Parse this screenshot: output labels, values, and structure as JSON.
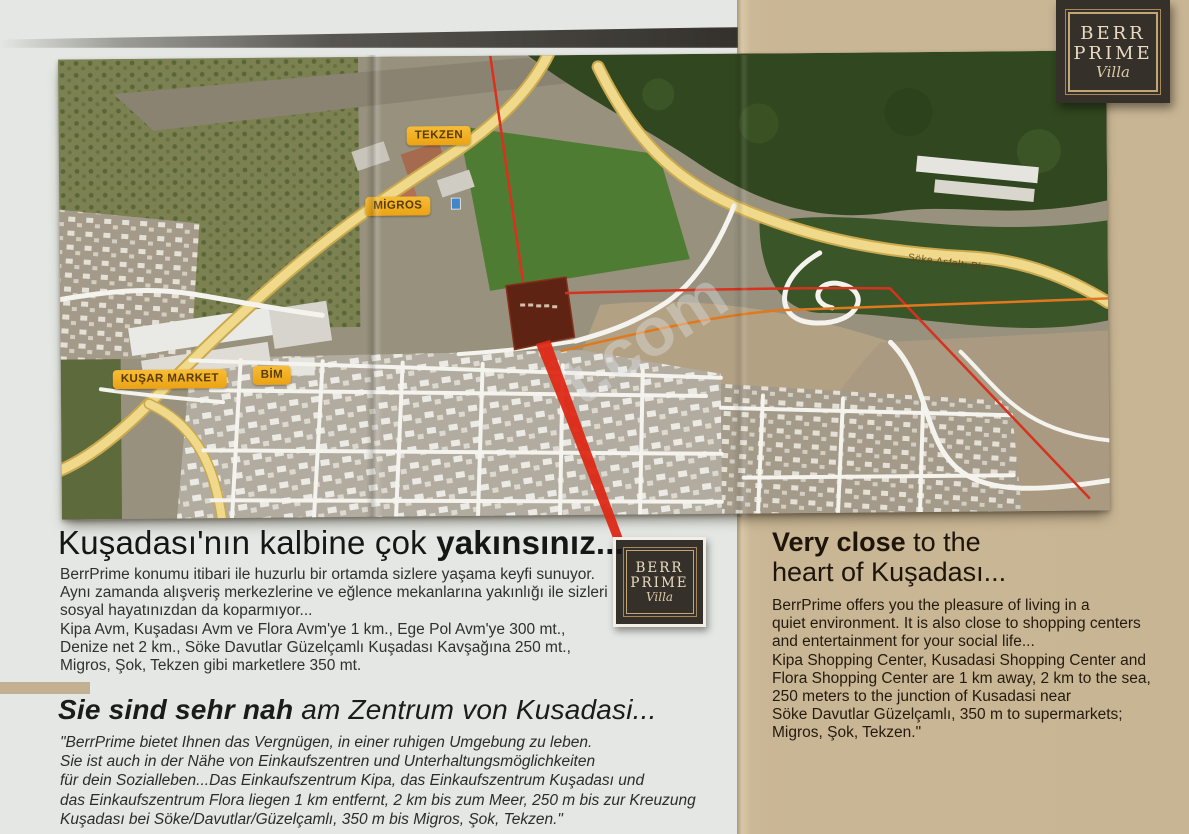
{
  "page": {
    "bg_left": "#e4e7e3",
    "bg_right": "#c9b695",
    "divider_color": "#c3b091"
  },
  "brand": {
    "word1": "BERR",
    "word2": "PRIME",
    "script": "Villa"
  },
  "map": {
    "labels": [
      {
        "text": "TEKZEN"
      },
      {
        "text": "MİGROS"
      },
      {
        "text": "KUŞAR MARKET"
      },
      {
        "text": "BİM"
      }
    ],
    "road_label": "Söke Asfaltı Blv.",
    "watermark": "t.com",
    "label_bg": "#f2ae1c",
    "label_text": "#5a3c05",
    "plot_color": "#5e2312",
    "route_red": "#de2917",
    "route_orange": "#e0791e",
    "road_yellow": "#f0d98b"
  },
  "sections": {
    "turkish": {
      "heading_regular": "Kuşadası'nın kalbine çok ",
      "heading_bold": "yakınsınız...",
      "body": "BerrPrime konumu itibari ile huzurlu bir ortamda sizlere yaşama keyfi sunuyor.\nAynı zamanda alışveriş merkezlerine ve eğlence mekanlarına yakınlığı ile sizleri\nsosyal hayatınızdan da koparmıyor...\nKipa Avm, Kuşadası Avm ve Flora Avm'ye 1 km., Ege Pol Avm'ye 300 mt.,\nDenize net 2 km., Söke Davutlar Güzelçamlı Kuşadası Kavşağına 250 mt.,\nMigros, Şok, Tekzen gibi marketlere 350 mt."
    },
    "german": {
      "heading_bold": "Sie sind sehr nah",
      "heading_regular": " am Zentrum von Kusadasi...",
      "body": "\"BerrPrime bietet Ihnen das Vergnügen, in einer ruhigen Umgebung zu leben.\nSie ist auch in der Nähe von Einkaufszentren und Unterhaltungsmöglichkeiten\nfür dein Sozialleben...Das Einkaufszentrum Kipa, das Einkaufszentrum Kuşadası und\ndas Einkaufszentrum Flora liegen 1 km entfernt, 2 km bis zum Meer, 250 m bis zur Kreuzung\nKuşadası bei Söke/Davutlar/Güzelçamlı, 350 m bis Migros, Şok, Tekzen.\""
    },
    "english": {
      "heading_bold": "Very close",
      "heading_regular": " to the\nheart of Kuşadası...",
      "body": "BerrPrime offers you the pleasure of living in a\nquiet environment. It is also close to shopping centers\nand entertainment for your social life...\nKipa Shopping Center, Kusadasi Shopping Center and\nFlora Shopping Center are 1 km away, 2 km to the sea,\n250 meters to the junction of Kusadasi near\nSöke Davutlar Güzelçamlı, 350 m to supermarkets;\nMigros, Şok, Tekzen.\""
    }
  }
}
